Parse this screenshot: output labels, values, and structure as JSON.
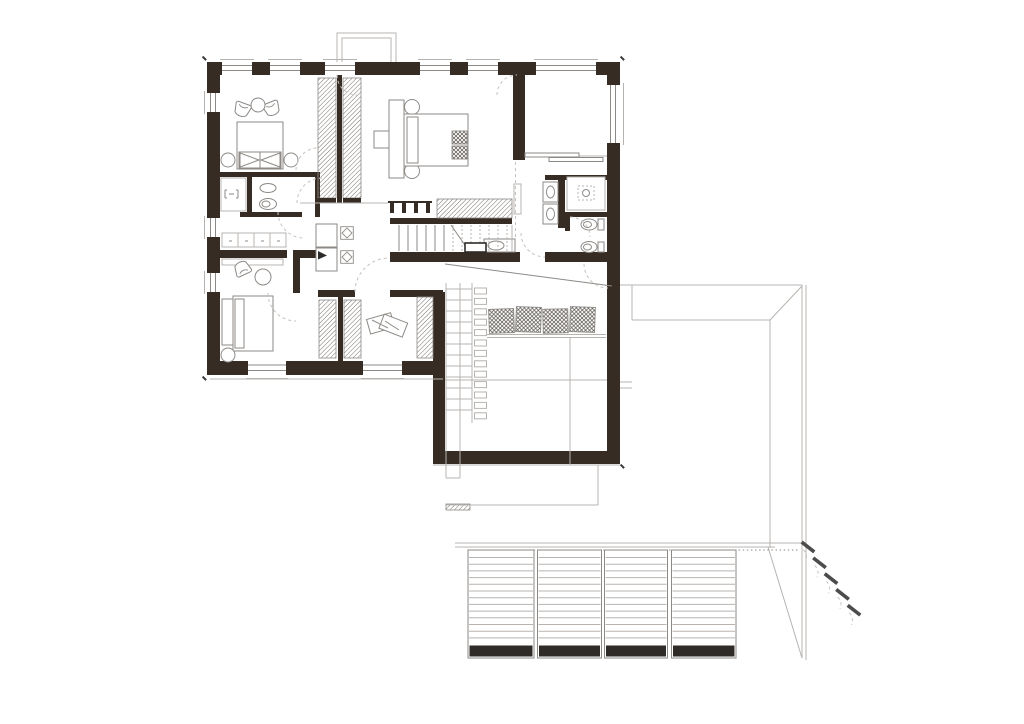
{
  "document": {
    "kind": "architectural-floor-plan",
    "sheet": "upper-floor-plan-with-roof-terrace",
    "background": "#ffffff",
    "has_text_labels": false
  },
  "colors": {
    "wall": "#362c24",
    "line_mid": "#8d8a86",
    "line_light": "#b7b4b0",
    "hatch": "#55504a",
    "slat_bar": "#2e2b28",
    "dash": "#c6c2bd",
    "accent_dark": "#3a3a3a"
  },
  "plan": {
    "rooms": [
      {
        "id": "bedroom-1",
        "position": "top-left",
        "furniture": [
          "double-bed",
          "armchair",
          "armchair",
          "round-table",
          "side-table",
          "side-table"
        ]
      },
      {
        "id": "bathroom-1",
        "position": "left",
        "fixtures": [
          "shower",
          "washbasin",
          "toilet"
        ]
      },
      {
        "id": "hall-cabinets",
        "position": "left-center",
        "furniture": [
          "drawer-row",
          "shelf"
        ]
      },
      {
        "id": "bedroom-2-master",
        "position": "top-center",
        "furniture": [
          "double-bed",
          "headboard-board",
          "bench",
          "desk",
          "side-table",
          "side-table",
          "hatched-pillows"
        ]
      },
      {
        "id": "loggia",
        "position": "top-right",
        "features": [
          "sliding-glass-door",
          "open-corner-window"
        ]
      },
      {
        "id": "bathroom-2",
        "position": "right",
        "fixtures": [
          "double-washbasin",
          "shower",
          "toilet",
          "bidet",
          "washbasin"
        ]
      },
      {
        "id": "walk-in-closet-1",
        "position": "center",
        "features": [
          "hatched-wardrobe-left",
          "hatched-wardrobe-right"
        ]
      },
      {
        "id": "bedroom-3",
        "position": "bottom-left",
        "furniture": [
          "bed",
          "armchair",
          "round-table"
        ]
      },
      {
        "id": "walk-in-closet-2",
        "position": "bottom-center",
        "features": [
          "hatched-wardrobe-left",
          "hatched-wardrobe-right"
        ]
      },
      {
        "id": "dressing-room",
        "position": "bottom-center",
        "features": [
          "hatched-wardrobe",
          "clothes-pile"
        ]
      },
      {
        "id": "hall",
        "position": "center",
        "furniture": [
          "double-desk",
          "desk-chair",
          "desk-chair"
        ],
        "features": [
          "stair-railing"
        ]
      },
      {
        "id": "staircase",
        "position": "center-right",
        "treads": 13,
        "features": [
          "hatched-closet-above",
          "break-line"
        ]
      },
      {
        "id": "void-over-living",
        "position": "below-center",
        "features": [
          "ramp-line",
          "wall-ladder",
          "bench-with-cushions"
        ]
      },
      {
        "id": "terrace",
        "position": "bottom-right",
        "features": [
          "roof-opening-outline",
          "louvered-panels",
          "garden-steps"
        ]
      }
    ],
    "counts": {
      "top_windows": 6,
      "left_windows": 3,
      "bottom_windows": 2,
      "right_windows": 1,
      "stair_treads": 13,
      "louver_panels": 4,
      "louver_lines_per_panel": 13,
      "bench_cushions": 4,
      "garden_step_markers": 5,
      "ladder_rungs": 12,
      "ladder_blocks": 13
    }
  }
}
